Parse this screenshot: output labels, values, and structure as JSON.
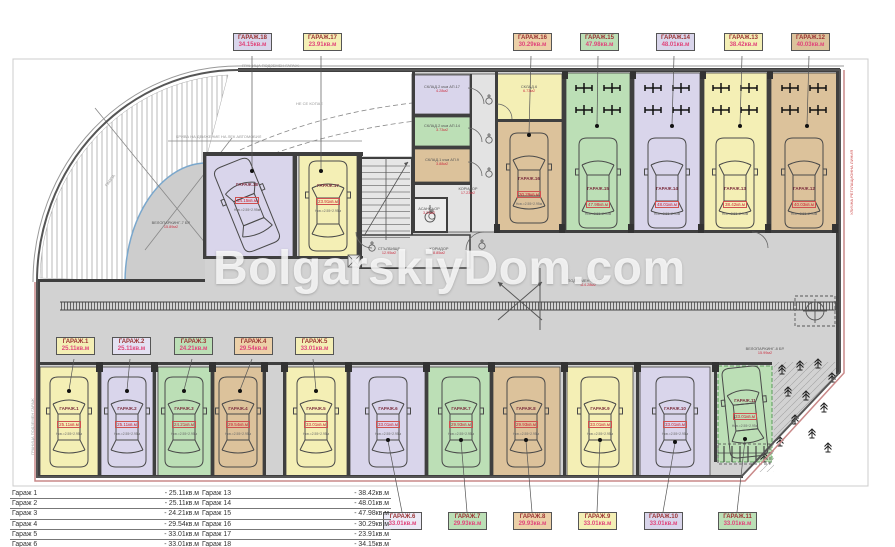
{
  "watermark": "BolgarskiyDom.com",
  "colors": {
    "yellow": "#f4efb5",
    "lavender": "#d9d5eb",
    "green": "#bcdfb6",
    "tan": "#dcc29b",
    "aisle_gray": "#d2d2d2",
    "label_title_red": "#9c3333",
    "label_value_pink": "#e0457b",
    "area_red": "#cc3344",
    "boundary_pink": "#c98989"
  },
  "plan": {
    "garage_labels": {
      "top": [
        {
          "name": "ГАРАЖ.18",
          "area": "34.15кв.м"
        },
        {
          "name": "ГАРАЖ.17",
          "area": "23.91кв.м"
        },
        {
          "name": "ГАРАЖ.16",
          "area": "30.29кв.м"
        },
        {
          "name": "ГАРАЖ.15",
          "area": "47.98кв.м"
        },
        {
          "name": "ГАРАЖ.14",
          "area": "48.01кв.м"
        },
        {
          "name": "ГАРАЖ.13",
          "area": "38.42кв.м"
        },
        {
          "name": "ГАРАЖ.12",
          "area": "40.03кв.м"
        }
      ],
      "mid": [
        {
          "name": "ГАРАЖ.1",
          "area": "25.11кв.м"
        },
        {
          "name": "ГАРАЖ.2",
          "area": "25.11кв.м"
        },
        {
          "name": "ГАРАЖ.3",
          "area": "24.21кв.м"
        },
        {
          "name": "ГАРАЖ.4",
          "area": "29.54кв.м"
        },
        {
          "name": "ГАРАЖ.5",
          "area": "33.01кв.м"
        }
      ],
      "bottom": [
        {
          "name": "ГАРАЖ.6",
          "area": "33.01кв.м"
        },
        {
          "name": "ГАРАЖ.7",
          "area": "29.93кв.м"
        },
        {
          "name": "ГАРАЖ.8",
          "area": "29.93кв.м"
        },
        {
          "name": "ГАРАЖ.9",
          "area": "33.01кв.м"
        },
        {
          "name": "ГАРАЖ.10",
          "area": "33.01кв.м"
        },
        {
          "name": "ГАРАЖ.11",
          "area": "33.01кв.м"
        }
      ]
    },
    "card_note": "Нсв.=2.55÷2.95м",
    "cards": {
      "g1": {
        "name": "ГАРАЖ.1",
        "area": "25.11кв.м"
      },
      "g2": {
        "name": "ГАРАЖ.2",
        "area": "25.11кв.м"
      },
      "g3": {
        "name": "ГАРАЖ.3",
        "area": "24.21кв.м"
      },
      "g4": {
        "name": "ГАРАЖ.4",
        "area": "29.54кв.м"
      },
      "g5": {
        "name": "ГАРАЖ.5",
        "area": "33.01кв.м"
      },
      "g6": {
        "name": "ГАРАЖ.6",
        "area": "33.01кв.м"
      },
      "g7": {
        "name": "ГАРАЖ.7",
        "area": "29.93кв.м"
      },
      "g8": {
        "name": "ГАРАЖ.8",
        "area": "29.93кв.м"
      },
      "g9": {
        "name": "ГАРАЖ.9",
        "area": "33.01кв.м"
      },
      "g10": {
        "name": "ГАРАЖ.10",
        "area": "33.01кв.м"
      },
      "g11": {
        "name": "ГАРАЖ.11",
        "area": "33.01кв.м"
      },
      "g12": {
        "name": "ГАРАЖ.12",
        "area": "40.03кв.м"
      },
      "g13": {
        "name": "ГАРАЖ.13",
        "area": "38.42кв.м"
      },
      "g14": {
        "name": "ГАРАЖ.14",
        "area": "48.01кв.м"
      },
      "g15": {
        "name": "ГАРАЖ.15",
        "area": "47.98кв.м"
      },
      "g16": {
        "name": "ГАРАЖ.16",
        "area": "30.29кв.м"
      },
      "g17": {
        "name": "ГАРАЖ.17",
        "area": "23.91кв.м"
      },
      "g18": {
        "name": "ГАРАЖ.18",
        "area": "34.15кв.м"
      }
    },
    "rooms": {
      "sklad_ap17": {
        "name": "СКЛАД.2 към АП.17",
        "area": "4.28м2"
      },
      "sklad_ap14": {
        "name": "СКЛАД.2 към АП.14",
        "area": "3.73м2"
      },
      "sklad_ap9": {
        "name": "СКЛАД.1 към АП.9",
        "area": "3.88м2"
      },
      "sklad6": {
        "name": "СКЛАД.6",
        "area": "6.73м2"
      },
      "elevator": {
        "name": "АСАНСЬОР",
        "area": "3.23м2"
      },
      "corridor1": {
        "name": "КОРИДОР",
        "area": "17.23м2"
      },
      "stairs": {
        "name": "СТЪЛБИЩЕ",
        "area": "12.95м2"
      },
      "corridor2": {
        "name": "КОРИДОР",
        "area": "8.85м2"
      },
      "parking": {
        "name": "ПОДЗЕМЕН ПАРКИНГ",
        "area": "114.28м2"
      },
      "velo7": {
        "name": "ВЕЛОПАРКИНГ-7 БР.",
        "area": "15.89м2"
      },
      "velo8": {
        "name": "ВЕЛОПАРКИНГ-8 БР.",
        "area": "15.99м2"
      }
    },
    "annotations": {
      "top_edge": "ГРАНИЦА ПОДЗЕМЕН ГАРАЖ",
      "no_dig": "НЕ СЕ КОПАЕ",
      "curve_note": "КРИВА НА ДВИЖЕНИЕ НА ЛЕК АВТОМОБИЛ",
      "ramp_note": "РАМПА",
      "right_edge": "УЛИЧНА РЕГУЛАЦИОННА ЛИНИЯ",
      "left_edge": "ГРАНИЦА ПОДЗЕМЕН ГАРАЖ"
    }
  },
  "legend": {
    "left": [
      {
        "n": "Гараж 1",
        "v": "-  25.11кв.м"
      },
      {
        "n": "Гараж 2",
        "v": "-  25.11кв.м"
      },
      {
        "n": "Гараж 3",
        "v": "-  24.21кв.м"
      },
      {
        "n": "Гараж 4",
        "v": "-  29.54кв.м"
      },
      {
        "n": "Гараж 5",
        "v": "-  33.01кв.м"
      },
      {
        "n": "Гараж 6",
        "v": "-  33.01кв.м"
      },
      {
        "n": "Гараж 7",
        "v": "-  29.93кв.м"
      }
    ],
    "right": [
      {
        "n": "Гараж 13",
        "v": "-  38.42кв.м"
      },
      {
        "n": "Гараж 14",
        "v": "-  48.01кв.м"
      },
      {
        "n": "Гараж 15",
        "v": "-  47.98кв.м"
      },
      {
        "n": "Гараж 16",
        "v": "-  30.29кв.м"
      },
      {
        "n": "Гараж 17",
        "v": "-  23.91кв.м"
      },
      {
        "n": "Гараж 18",
        "v": "-  34.15кв.м"
      }
    ]
  }
}
